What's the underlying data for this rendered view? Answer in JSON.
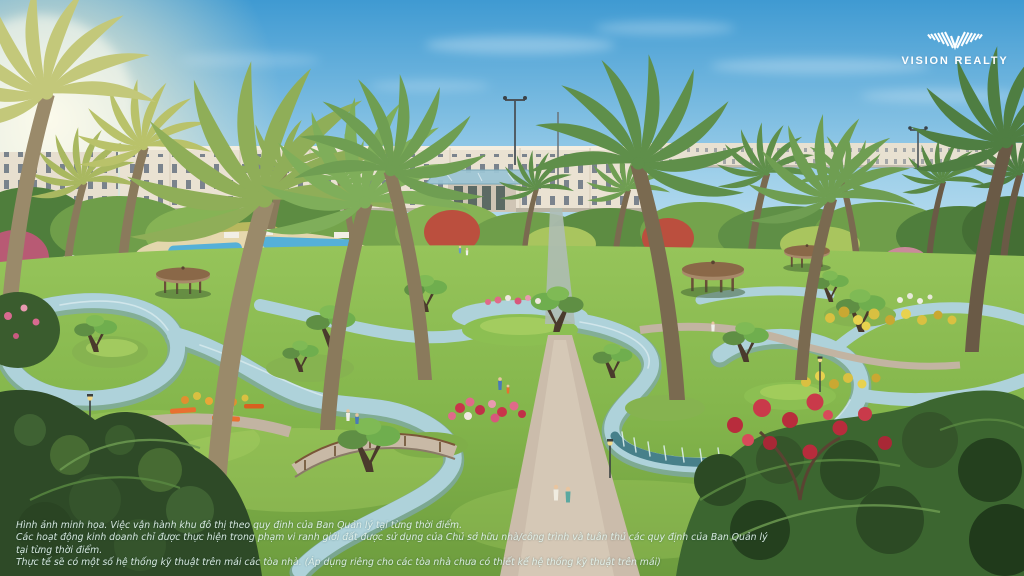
{
  "meta": {
    "type": "architectural-render",
    "subject": "Aerial rendering of a landscaped resort park with a winding lazy river, palm trees, round gazebos, flower beds and rows of shophouses on the horizon"
  },
  "logo": {
    "name": "VISION REALTY",
    "color": "#ffffff",
    "icon": "striped-wings-v-emblem"
  },
  "disclaimer": {
    "lines": [
      "Hình ảnh minh họa. Việc vận hành khu đô thị theo quy định của Ban Quản lý tại từng thời điểm.",
      "Các hoạt động kinh doanh chỉ được thực hiện trong phạm vi ranh giới đất được sử dụng của Chủ sở hữu nhà/công trình và tuân thủ các quy định của Ban Quản lý tại từng thời điểm.",
      "Thực tế sẽ có một số hệ thống kỹ thuật trên mái các tòa nhà. (Áp dụng riêng cho các tòa nhà chưa có thiết kế hệ thống kỹ thuật trên mái)"
    ]
  },
  "palette": {
    "sky_top": "#4aa0d6",
    "sky_horizon": "#dcedf3",
    "sun_glow": "#fff3cf",
    "water": "#aed2da",
    "water_deep": "#7fa8b2",
    "grass": "#8cbf52",
    "grass_dark": "#6f9e3f",
    "path_tan": "#cbbcab",
    "building_facade": "#eae2d2",
    "window": "#5e6c7c",
    "glass_canopy": "#9cc4d4",
    "palm_green": "#6f9e52",
    "palm_backlit": "#b9c26a",
    "gazebo_roof": "#8a6848",
    "flower_pink": "#e06a8a",
    "flower_red": "#c03048",
    "flower_yellow": "#d9c041",
    "bench_orange": "#e87030",
    "foliage_dark": "#2e4a27"
  }
}
